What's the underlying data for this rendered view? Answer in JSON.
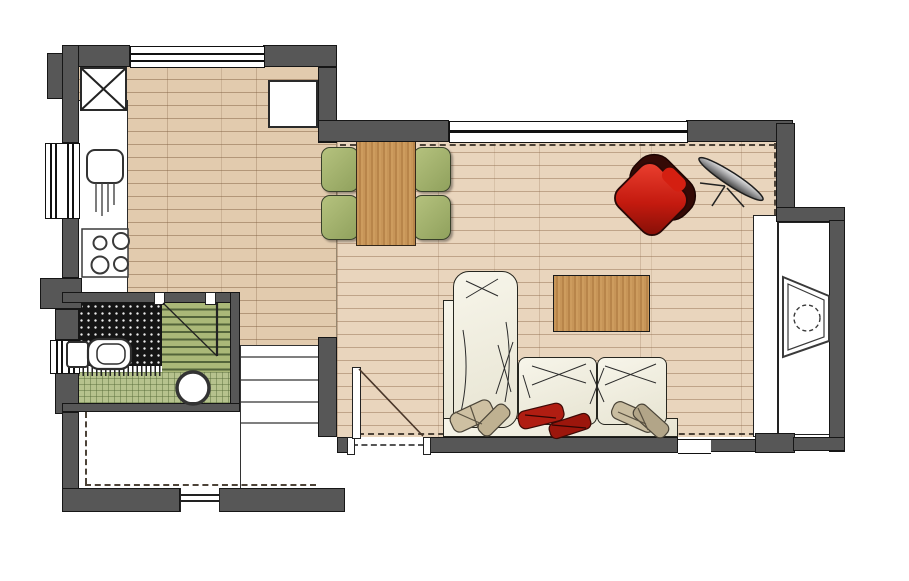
{
  "meta": {
    "type": "architectural-floor-plan",
    "width_px": 909,
    "height_px": 581,
    "visible_text": "none"
  },
  "palette": {
    "wall": "#575757",
    "wall_outline": "#161616",
    "kitchen_floor": "#e2cbae",
    "living_floor": "#e9d5bd",
    "table_wood": "#c08c52",
    "chair_green": "#a3b46e",
    "sofa_cream": "#f2efe2",
    "armchair_red": "#c21f14",
    "bath_mat_green": "#aab878",
    "bath_plaid_green": "#b6c28d",
    "shower_tile_dark": "#151515",
    "lamp_gray": "#b9babc"
  },
  "rooms": [
    {
      "name": "kitchen",
      "features": [
        "counter",
        "sink",
        "cooktop",
        "fridge-x-box",
        "wall-cabinet",
        "top-window",
        "left-window"
      ]
    },
    {
      "name": "dining-area",
      "features": [
        "dining-table",
        "four-green-chairs"
      ]
    },
    {
      "name": "living-room",
      "features": [
        "l-shaped-sofa",
        "coffee-table",
        "red-armchair",
        "floor-lamp",
        "wide-top-window",
        "entry-door"
      ]
    },
    {
      "name": "bathroom",
      "features": [
        "dark-tiled-shower",
        "striped-mat",
        "plaid-floor",
        "toilet",
        "round-basin",
        "door",
        "left-window"
      ]
    },
    {
      "name": "staircase",
      "features": [
        "four-treads"
      ]
    },
    {
      "name": "porch",
      "features": [
        "dashed-roof-outline",
        "threshold-opening"
      ]
    },
    {
      "name": "entry-niche",
      "features": [
        "wardrobe-strip",
        "trapezoid-fixture",
        "dashed-circle"
      ]
    }
  ],
  "furniture_counts": {
    "dining_chairs": 4,
    "sofa_cushions": 3,
    "throw_pillows": 6,
    "cooktop_burners": 4,
    "stair_treads": 4
  }
}
